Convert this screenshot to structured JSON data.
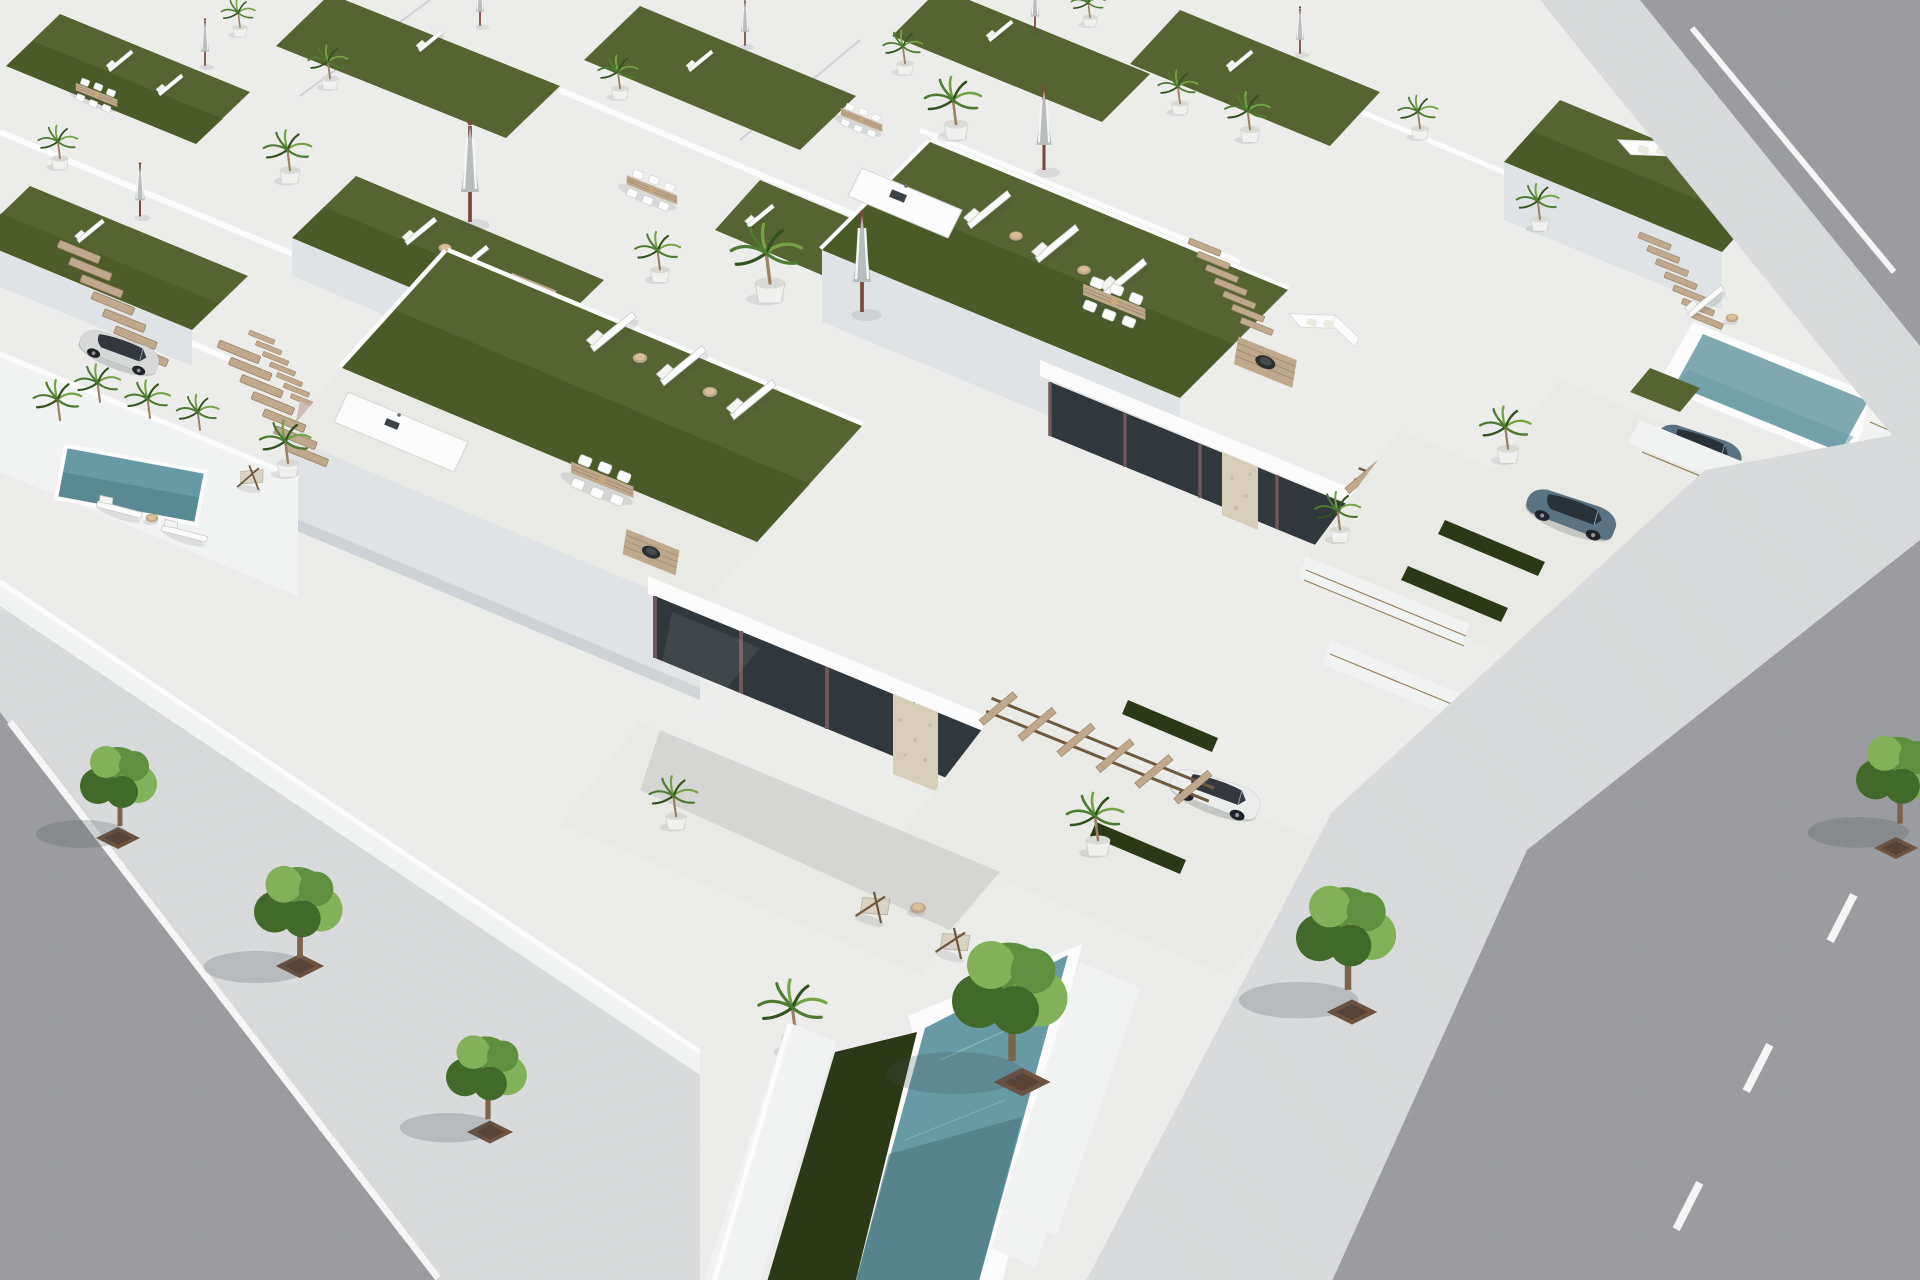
{
  "scene": {
    "type": "architectural-3d-render",
    "setting": "aerial-view-of-white-mediterranean-villa-development",
    "objects": [
      "rooftop-artificial-turf-terraces",
      "sun-loungers",
      "closed-striped-patio-umbrellas",
      "potted-palm-trees",
      "outdoor-dining-sets",
      "outdoor-kitchen-counters",
      "fire-pit-lounge-deck",
      "wooden-pergolas",
      "wooden-roof-stairs",
      "private-plunge-pools",
      "glass-door-facades",
      "stone-clad-pillars",
      "white-hatchback-car",
      "silver-car",
      "blue-suv-pair",
      "asphalt-streets",
      "white-lane-markings",
      "paver-sidewalks",
      "street-trees",
      "tree-planting-pits"
    ]
  },
  "palette": {
    "base": "#ecedeb",
    "white": "#f1f2f2",
    "white-lit": "#fafbfa",
    "shade1": "#e0e3e5",
    "shade2": "#cdd2d6",
    "shade3": "#b9c0c6",
    "tile": "#e9e9e5",
    "paver": "#d8dadb",
    "asphalt": "#9b9c9f",
    "line": "#f4f5f4",
    "turf": "#556430",
    "turf-dark": "#41501f",
    "turf-deep": "#2c3916",
    "pool": "#679aa4",
    "pool-deep": "#49767f",
    "pool-light": "#7fa9ae",
    "wood": "#bfa98d",
    "wood-dark": "#96805f",
    "wood-deep": "#6f5a40",
    "stone": "#d8cdb8",
    "glass-dark": "#31383d",
    "frame": "#6e585a",
    "palm": "#4e7a32",
    "palm-light": "#74a246",
    "palm-dark": "#335220",
    "tree": "#5f9040",
    "tree-light": "#82b159",
    "tree-dark": "#416a2a",
    "pot": "#f0f1ee",
    "pot2": "#d9dad6",
    "pit": "#6d5340",
    "car-white": "#ebedec",
    "car-silver": "#d7d9d9",
    "suv": "#5b7282",
    "car-glass": "#272e34",
    "shadow": "rgba(70,78,84,0.22)",
    "shadow-soft": "rgba(70,78,84,0.12)",
    "accent-pink-wall": "#c9b3ae",
    "trunk": "#7c6448"
  }
}
